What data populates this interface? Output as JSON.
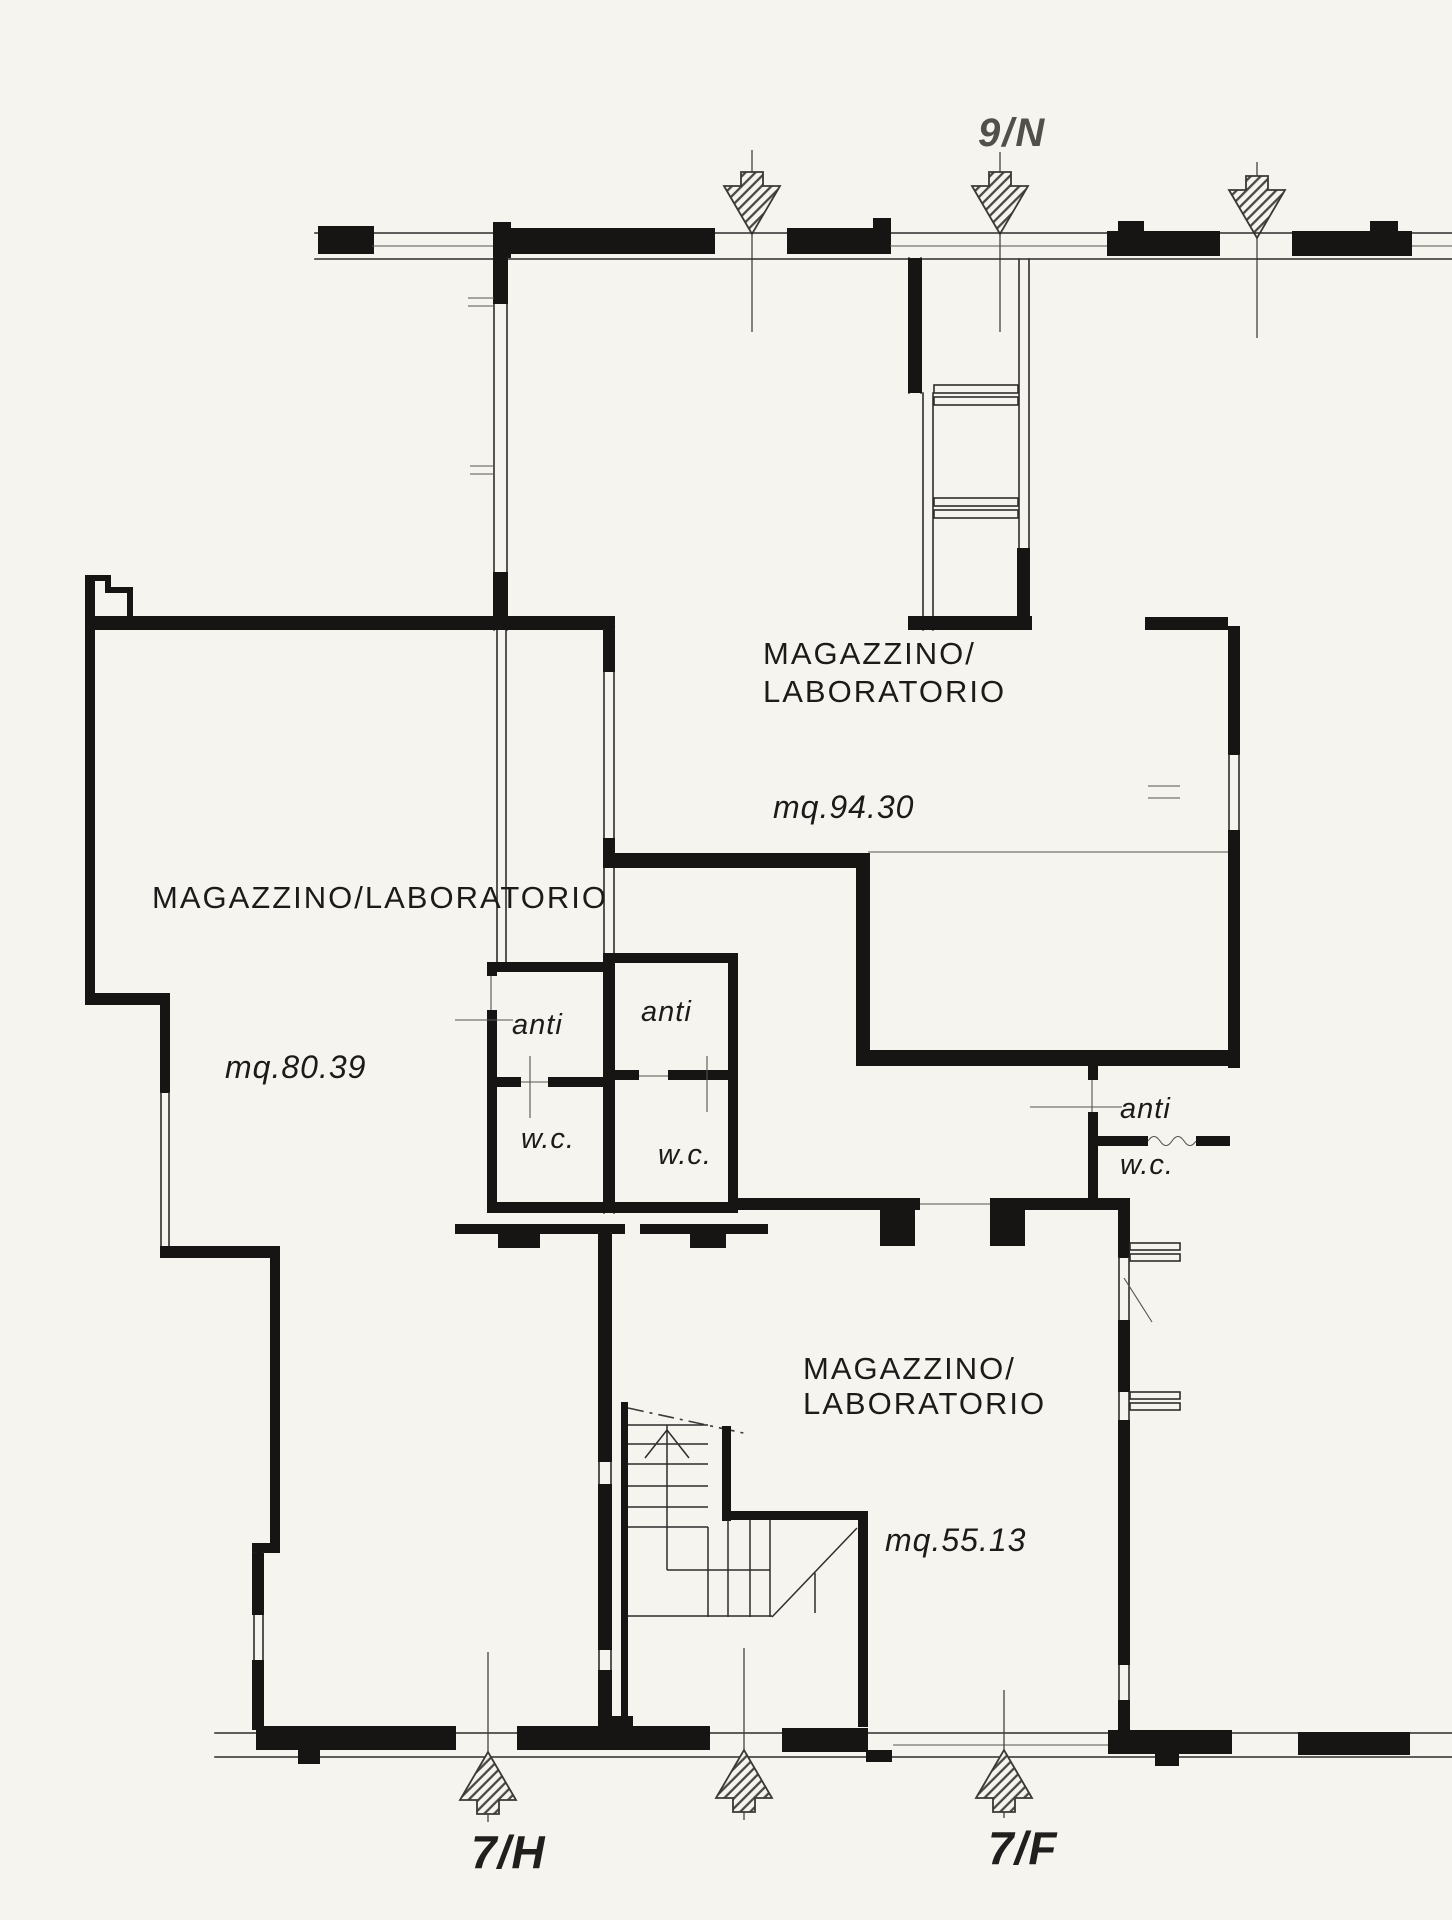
{
  "page": {
    "background": "#f5f4ef",
    "ink": "#161513",
    "type": "cadastral floor plan"
  },
  "labels": {
    "unit_top": "9/N",
    "unit_bottom_left": "7/H",
    "unit_bottom_right": "7/F"
  },
  "rooms": {
    "top": {
      "line1": "MAGAZZINO/",
      "line2": "LABORATORIO",
      "area": "mq.94.30"
    },
    "left": {
      "name": "MAGAZZINO/LABORATORIO",
      "area": "mq.80.39"
    },
    "bottom": {
      "line1": "MAGAZZINO/",
      "line2": "LABORATORIO",
      "area": "mq.55.13"
    }
  },
  "service": {
    "anti_left": "anti",
    "anti_center": "anti",
    "anti_right": "anti",
    "wc_left": "w.c.",
    "wc_center": "w.c.",
    "wc_right": "w.c."
  }
}
